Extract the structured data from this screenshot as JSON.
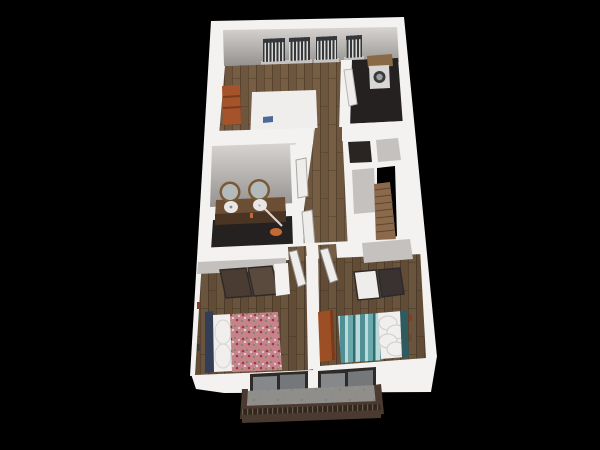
{
  "scene": {
    "type": "3d-floorplan-render",
    "rooms": [
      {
        "name": "living-room",
        "furniture": [
          "sofa",
          "bookshelf",
          "three-windows-with-blinds"
        ]
      },
      {
        "name": "laundry-room",
        "furniture": [
          "washer",
          "wall-cabinet",
          "window-with-blinds",
          "open-door"
        ]
      },
      {
        "name": "bathroom",
        "furniture": [
          "double-vanity",
          "two-round-mirrors",
          "two-sinks",
          "glass-shower",
          "orange-towel"
        ]
      },
      {
        "name": "hallway",
        "furniture": [
          "white-doors"
        ]
      },
      {
        "name": "staircase",
        "furniture": [
          "wood-steps",
          "stairwell-void"
        ]
      },
      {
        "name": "bedroom-left",
        "furniture": [
          "bed-floral-duvet",
          "navy-headboard",
          "pillows",
          "closet-sliding-doors",
          "wall-art"
        ]
      },
      {
        "name": "bedroom-right",
        "furniture": [
          "bed-teal-striped-duvet",
          "pillows",
          "orange-dresser",
          "closet-sliding-doors",
          "open-door",
          "wall-art"
        ]
      },
      {
        "name": "balcony",
        "furniture": [
          "concrete-floor",
          "brown-railing",
          "two-sliding-glass-doors"
        ]
      }
    ]
  },
  "colors": {
    "background": "#000000",
    "wall_top": "#f3f2f0",
    "wall_face_light": "#d7d4d1",
    "wall_face_dark": "#94918e",
    "wall_face_flat": "#c3c0bd",
    "wood_base": "#6e553d",
    "wood_plank_alt": "#775f45",
    "wood_line": "#55422f",
    "dark_floor": "#242120",
    "sofa": "#efeeec",
    "sofa_back": "#dddbd8",
    "laptop_blue": "#4a6a9a",
    "accent_orange": "#a5532b",
    "cabinet_wood": "#8a6a45",
    "washer_body": "#d9d7d5",
    "washer_door": "#3b3b3b",
    "washer_glass": "#9aa0a2",
    "mirror_frame": "#7a5a35",
    "mirror_glass": "#b2babc",
    "vanity_wood": "#6b4e33",
    "vanity_front": "#4a3524",
    "sink": "#e9e7e5",
    "towel_orange": "#c46a30",
    "stairs_wood": "#8a6a4a",
    "stairs_line": "#5e4632",
    "void_black": "#000000",
    "closet_floor": "#c4c1be",
    "closet_dark_floor": "#2a2523",
    "door_white": "#eeedeb",
    "door_edge": "#9a9896",
    "door_frame": "#2e2a27",
    "glass": "#85898b",
    "glass_dark": "#74787a",
    "blind_slat": "#35373a",
    "blind_gap": "#d8d8d6",
    "sill": "#c6c3c0",
    "bed1_base": "#c5848d",
    "bed1_dot_red": "#9c3a40",
    "bed1_dot_green": "#7c8a56",
    "bed1_dot_light": "#e7d9d6",
    "headboard_navy": "#333e56",
    "pillow": "#f1efed",
    "pillow_shadow": "#d5d3d0",
    "bed2_teal": "#4f8f95",
    "bed2_teal_light": "#bcd9da",
    "bed2_teal_mid": "#6aa8ac",
    "bed2_teal_dark": "#2f6d74",
    "headboard_teal": "#2f5a60",
    "dresser_orange": "#9c4e24",
    "dresser_front": "#7c3a18",
    "balcony_floor": "#908e8b",
    "concrete_dark": "#7e7c79",
    "concrete_light": "#a09e9b",
    "railing": "#4a3a30",
    "railing_dark": "#31271f",
    "railing_slit": "#6b5a4a",
    "art_red": "#8a3a28",
    "art_brown": "#6a4a30",
    "art_dark": "#3a3a3a"
  }
}
